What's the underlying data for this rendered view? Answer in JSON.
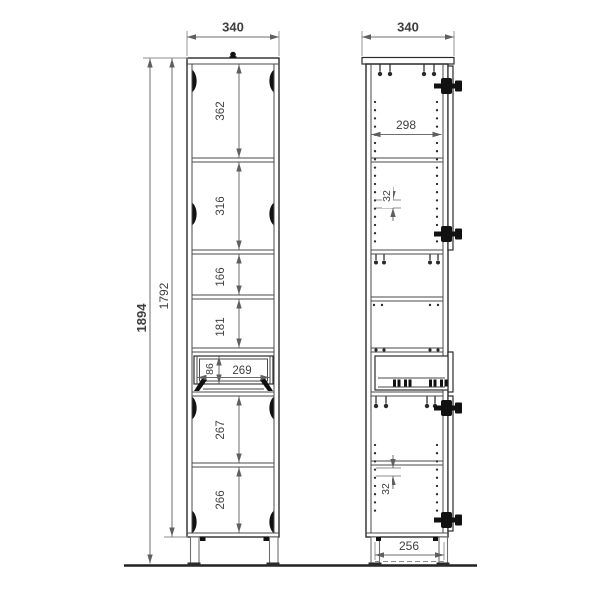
{
  "front": {
    "width": "340",
    "overall_height": "1894",
    "carcass_height": "1792",
    "sections": [
      "362",
      "316",
      "166",
      "181",
      "267",
      "266"
    ],
    "drawer_height": "86",
    "drawer_width": "269"
  },
  "side": {
    "width": "340",
    "inner_width": "298",
    "pitch_upper": "32",
    "pitch_lower": "32",
    "base_span": "256"
  },
  "colors": {
    "line": "#2b2b2b",
    "dim_line": "#6e6e6e",
    "text": "#3f3f3f",
    "hardware": "#111111",
    "background": "#ffffff"
  }
}
